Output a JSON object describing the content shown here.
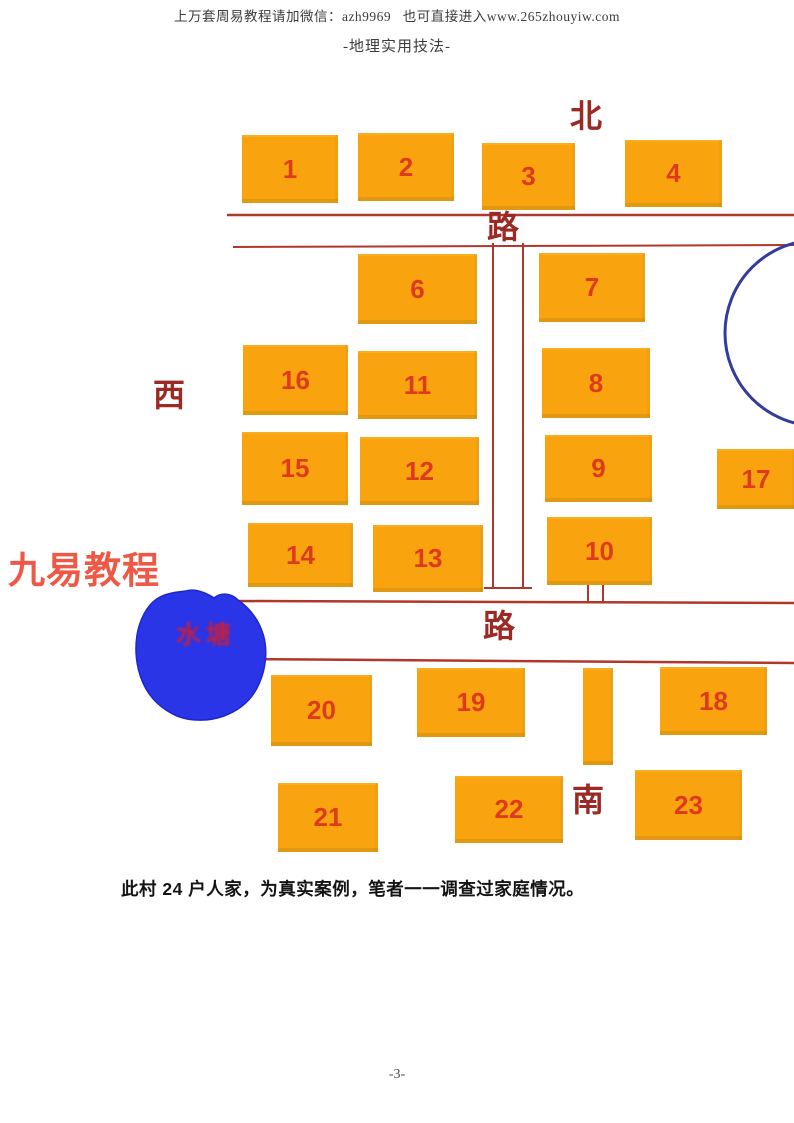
{
  "page": {
    "header_line1": "上万套周易教程请加微信：azh9969   也可直接进入www.265zhouyiw.com",
    "header_line2": "-地理实用技法-",
    "caption": "此村 24 户人家，为真实案例，笔者一一调查过家庭情况。",
    "footer": "-3-",
    "watermark": "九易教程",
    "pond_label": "水塘"
  },
  "colors": {
    "house_fill": "#f9a40e",
    "house_number": "#df3a1e",
    "road_line": "#b0372b",
    "map_label": "#9c2a24",
    "watermark": "#ee5947",
    "pond_fill": "#2a35e8",
    "pond_stroke": "#1d27c9",
    "pond_label": "#c01f45",
    "circle_stroke": "#323c9c"
  },
  "map": {
    "houses": [
      {
        "n": "1",
        "x": 242,
        "y": 135,
        "w": 96,
        "h": 68
      },
      {
        "n": "2",
        "x": 358,
        "y": 133,
        "w": 96,
        "h": 68
      },
      {
        "n": "3",
        "x": 482,
        "y": 143,
        "w": 93,
        "h": 67
      },
      {
        "n": "4",
        "x": 625,
        "y": 140,
        "w": 97,
        "h": 67
      },
      {
        "n": "6",
        "x": 358,
        "y": 254,
        "w": 119,
        "h": 70
      },
      {
        "n": "7",
        "x": 539,
        "y": 253,
        "w": 106,
        "h": 69
      },
      {
        "n": "16",
        "x": 243,
        "y": 345,
        "w": 105,
        "h": 70
      },
      {
        "n": "11",
        "x": 358,
        "y": 351,
        "w": 119,
        "h": 68
      },
      {
        "n": "8",
        "x": 542,
        "y": 348,
        "w": 108,
        "h": 70
      },
      {
        "n": "15",
        "x": 242,
        "y": 432,
        "w": 106,
        "h": 73
      },
      {
        "n": "12",
        "x": 360,
        "y": 437,
        "w": 119,
        "h": 68
      },
      {
        "n": "9",
        "x": 545,
        "y": 435,
        "w": 107,
        "h": 67
      },
      {
        "n": "17",
        "x": 717,
        "y": 449,
        "w": 78,
        "h": 60
      },
      {
        "n": "14",
        "x": 248,
        "y": 523,
        "w": 105,
        "h": 64
      },
      {
        "n": "13",
        "x": 373,
        "y": 525,
        "w": 110,
        "h": 67
      },
      {
        "n": "10",
        "x": 547,
        "y": 517,
        "w": 105,
        "h": 68
      },
      {
        "n": "20",
        "x": 271,
        "y": 675,
        "w": 101,
        "h": 71
      },
      {
        "n": "19",
        "x": 417,
        "y": 668,
        "w": 108,
        "h": 69
      },
      {
        "n": "",
        "x": 583,
        "y": 668,
        "w": 30,
        "h": 97
      },
      {
        "n": "18",
        "x": 660,
        "y": 667,
        "w": 107,
        "h": 68
      },
      {
        "n": "21",
        "x": 278,
        "y": 783,
        "w": 100,
        "h": 69
      },
      {
        "n": "22",
        "x": 455,
        "y": 776,
        "w": 108,
        "h": 67
      },
      {
        "n": "23",
        "x": 635,
        "y": 770,
        "w": 107,
        "h": 70
      }
    ],
    "labels": [
      {
        "name": "north-label",
        "text": "北",
        "x": 570,
        "y": 100,
        "size": 32
      },
      {
        "name": "west-label",
        "text": "西",
        "x": 153,
        "y": 379,
        "size": 32
      },
      {
        "name": "south-label",
        "text": "南",
        "x": 572,
        "y": 784,
        "size": 32
      },
      {
        "name": "road-label-top",
        "text": "路",
        "x": 487,
        "y": 211,
        "size": 32
      },
      {
        "name": "road-label-bottom",
        "text": "路",
        "x": 483,
        "y": 610,
        "size": 32
      }
    ],
    "roads": [
      {
        "name": "north-road-upper-line",
        "x1": 227,
        "y1": 215,
        "x2": 794,
        "y2": 215,
        "w": 2.5
      },
      {
        "name": "north-road-lower-line",
        "x1": 233,
        "y1": 247,
        "x2": 794,
        "y2": 245,
        "w": 2
      },
      {
        "name": "south-road-upper-line",
        "x1": 237,
        "y1": 601,
        "x2": 794,
        "y2": 603,
        "w": 2.5
      },
      {
        "name": "south-road-lower-line",
        "x1": 238,
        "y1": 659,
        "x2": 794,
        "y2": 663,
        "w": 2.5
      },
      {
        "name": "center-road-left-line",
        "x1": 493,
        "y1": 243,
        "x2": 493,
        "y2": 588,
        "w": 2
      },
      {
        "name": "center-road-right-line",
        "x1": 523,
        "y1": 243,
        "x2": 523,
        "y2": 588,
        "w": 2
      },
      {
        "name": "center-road-end-tick",
        "x1": 484,
        "y1": 588,
        "x2": 532,
        "y2": 588,
        "w": 2
      },
      {
        "name": "house10-gate-tick-left",
        "x1": 588,
        "y1": 585,
        "x2": 588,
        "y2": 602,
        "w": 2
      },
      {
        "name": "house10-gate-tick-right",
        "x1": 603,
        "y1": 585,
        "x2": 603,
        "y2": 602,
        "w": 2
      }
    ],
    "circle": {
      "cx": 818,
      "cy": 333,
      "r": 93,
      "w": 3
    },
    "pond_path": "M 186 591 C 196 588 208 594 214 598 C 220 593 230 592 238 600 C 248 607 258 618 263 634 C 268 650 266 668 259 684 C 252 700 240 710 224 716 C 210 721 192 722 177 716 C 163 710 150 699 143 683 C 136 667 134 648 138 630 C 142 614 150 602 160 597 C 168 593 177 592 186 591 Z"
  }
}
